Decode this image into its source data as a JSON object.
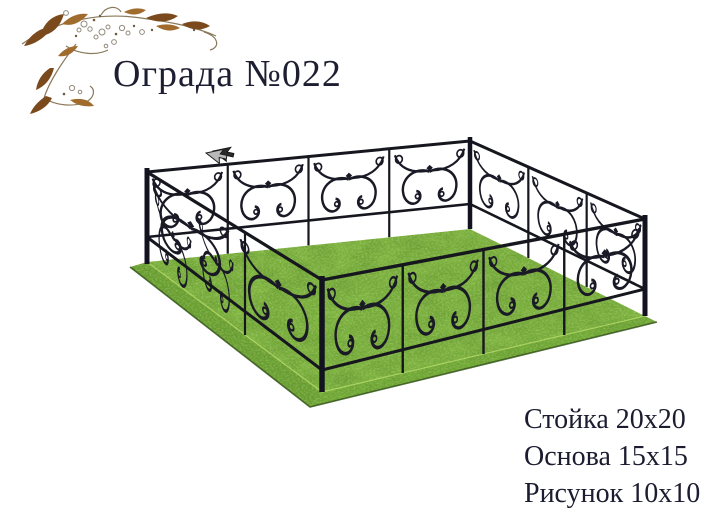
{
  "page": {
    "background_color": "#ffffff",
    "kind": "product catalog page"
  },
  "header": {
    "title": "Ограда №022",
    "title_color": "#1e1e32",
    "ornament_icon": "floral-flourish",
    "ornament_colors": {
      "leaf_dark_brown": "#7a4a1c",
      "leaf_light_brown": "#a06c2e",
      "engraving_gray": "#93897c"
    }
  },
  "product": {
    "name": "Ограда №022",
    "illustration": "wrought-iron-grave-fence-on-grass-mound",
    "colors": {
      "iron": "#1a1a27",
      "grass_top": "#7db33f",
      "grass_side_left": "#689f30",
      "grass_side_right": "#6fa934",
      "grass_shadow": "#2c4c12",
      "grass_highlight": "#bce06c"
    }
  },
  "specs": {
    "text_color": "#1c1c30",
    "lines": [
      {
        "label": "Стойка",
        "value": "20x20",
        "text": "Стойка 20x20"
      },
      {
        "label": "Основа",
        "value": "15x15",
        "text": "Основа 15x15"
      },
      {
        "label": "Рисунок",
        "value": "10x10",
        "text": "Рисунок 10x10"
      }
    ]
  },
  "cursor": {
    "icon": "arrow-pointer",
    "color": "#b8b8b8"
  }
}
